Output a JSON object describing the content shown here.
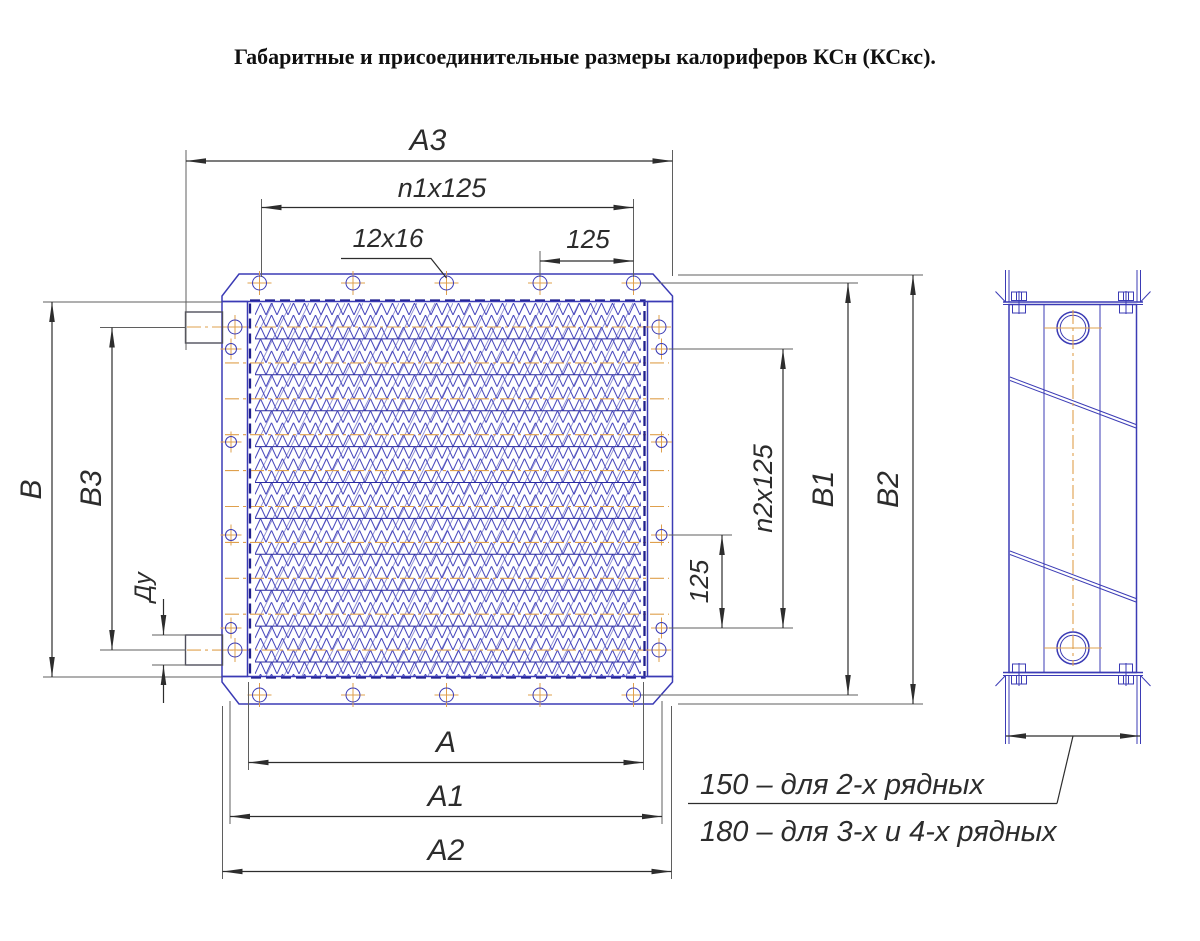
{
  "title": "Габаритные и присоединительные размеры калориферов КСн (КСкс).",
  "labels": {
    "a3": "A3",
    "n1_pitch": "n1x125",
    "bolt_holes": "12x16",
    "pitch_125_top": "125",
    "b": "B",
    "b3": "B3",
    "du": "Ду",
    "n2_pitch": "n2x125",
    "pitch_125_right": "125",
    "b1": "B1",
    "b2": "B2",
    "a": "A",
    "a1": "A1",
    "a2": "A2"
  },
  "notes": {
    "depth_2row": "150 – для 2-х рядных",
    "depth_34row": "180 – для 3-х и 4-х рядных"
  },
  "colors": {
    "part_blue": "#3b3bb5",
    "fin_blue": "#4545bc",
    "centerline_orange": "#dfa04d",
    "dimension_dark": "#2d2d2d",
    "extension_gray": "#5f5f5f",
    "dashed_navy": "#1f1f8c"
  }
}
